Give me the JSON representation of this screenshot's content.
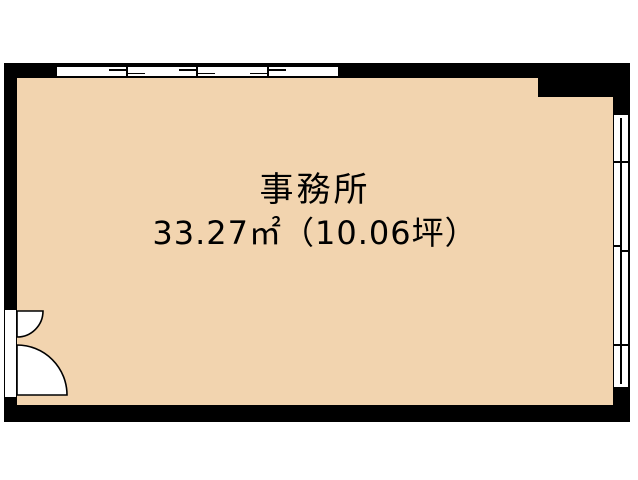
{
  "plan": {
    "room_label": "事務所",
    "area_label": "33.27㎡（10.06坪）"
  },
  "colors": {
    "floor_fill": "#F2D4AF",
    "wall": "#000000",
    "background": "#FFFFFF"
  },
  "features": {
    "top_window": "sliding-window-4-pane",
    "right_window": "sliding-window-3-section",
    "entrance": "double-swing-door-bottom-left"
  }
}
